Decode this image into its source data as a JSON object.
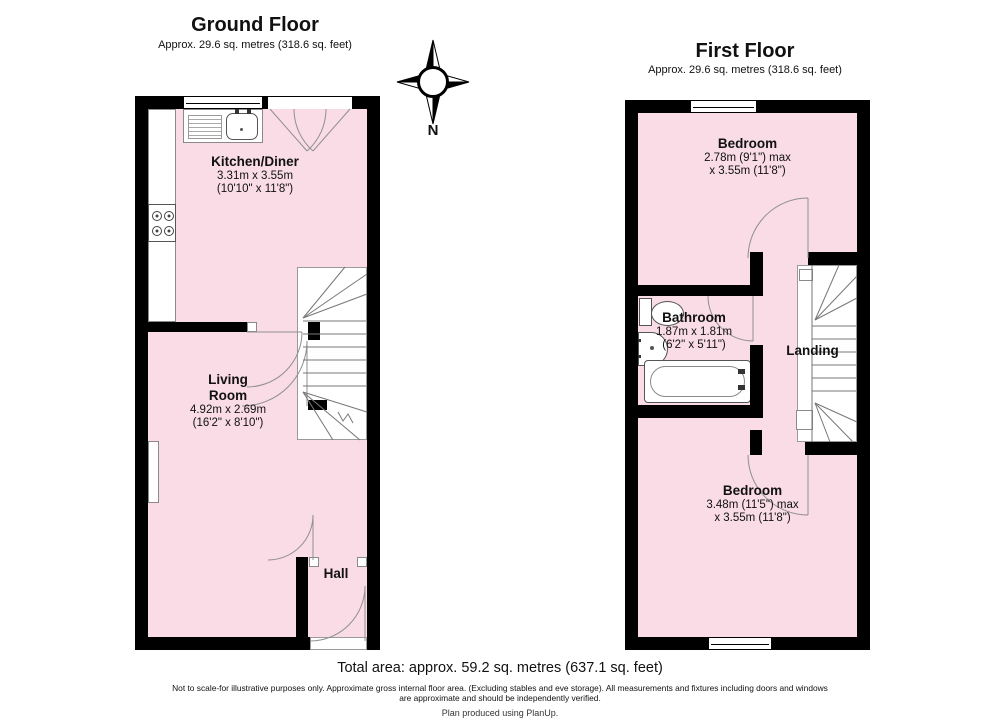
{
  "ground_floor": {
    "title": "Ground Floor",
    "subtitle": "Approx. 29.6 sq. metres (318.6 sq. feet)",
    "kitchen": {
      "name": "Kitchen/Diner",
      "dims1": "3.31m x 3.55m",
      "dims2": "(10'10\" x 11'8\")"
    },
    "living": {
      "name1": "Living",
      "name2": "Room",
      "dims1": "4.92m x 2.69m",
      "dims2": "(16'2\" x 8'10\")"
    },
    "hall": {
      "name": "Hall"
    }
  },
  "first_floor": {
    "title": "First Floor",
    "subtitle": "Approx. 29.6 sq. metres (318.6 sq. feet)",
    "bedroom_top": {
      "name": "Bedroom",
      "dims1": "2.78m (9'1\") max",
      "dims2": "x 3.55m (11'8\")"
    },
    "bathroom": {
      "name": "Bathroom",
      "dims1": "1.87m x 1.81m",
      "dims2": "(6'2\" x 5'11\")"
    },
    "landing": {
      "name": "Landing"
    },
    "bedroom_bottom": {
      "name": "Bedroom",
      "dims1": "3.48m (11'5\") max",
      "dims2": "x 3.55m (11'8\")"
    }
  },
  "compass": {
    "label": "N"
  },
  "footer": {
    "total_area": "Total area: approx. 59.2 sq. metres (637.1 sq. feet)",
    "disclaimer_line1": "Not to scale-for illustrative purposes only. Approximate gross internal floor area. (Excluding stables and eve storage). All measurements and fixtures including doors and windows",
    "disclaimer_line2": "are approximate and should be independently verified.",
    "credit": "Plan produced using PlanUp."
  },
  "colors": {
    "wall": "#000000",
    "room_fill": "#f9dce6",
    "door_arc": "#8f8f8f"
  },
  "fixtures": [
    "sink-drainer",
    "hob",
    "radiator",
    "staircase",
    "toilet",
    "basin",
    "bathtub",
    "compass-rose"
  ]
}
